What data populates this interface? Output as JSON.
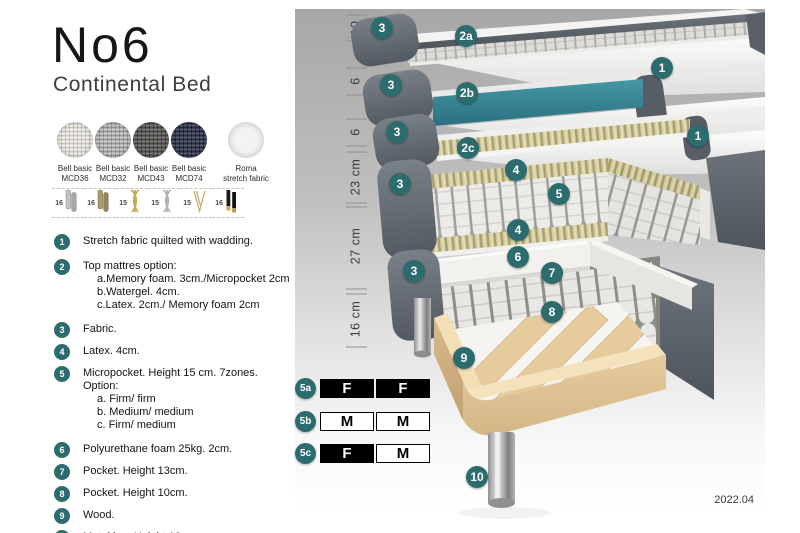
{
  "header": {
    "title": "No6",
    "subtitle": "Continental Bed"
  },
  "fabric_swatches": [
    {
      "line1": "Bell basic",
      "line2": "MCD36",
      "swatch": "weave-cream"
    },
    {
      "line1": "Bell basic",
      "line2": "MCD32",
      "swatch": "weave-grey"
    },
    {
      "line1": "Bell basic",
      "line2": "MCD43",
      "swatch": "weave-darkgrey"
    },
    {
      "line1": "Bell basic",
      "line2": "MCD74",
      "swatch": "weave-navy"
    },
    {
      "line1": "Roma",
      "line2": "stretch fabric",
      "swatch": "plain-white"
    }
  ],
  "leg_options": [
    {
      "height": "16",
      "icon": "cylinder-silver-leg"
    },
    {
      "height": "16",
      "icon": "cylinder-bronze-leg"
    },
    {
      "height": "15",
      "icon": "twisted-gold-leg"
    },
    {
      "height": "15",
      "icon": "twisted-silver-leg"
    },
    {
      "height": "15",
      "icon": "hairpin-leg"
    },
    {
      "height": "16",
      "icon": "black-gold-leg"
    }
  ],
  "features": [
    {
      "num": "1",
      "text": "Stretch fabric quilted with wadding.",
      "subitems": []
    },
    {
      "num": "2",
      "text": "Top mattres option:",
      "subitems": [
        "a.Memory foam. 3cm./Micropocket 2cm",
        "b.Watergel. 4cm.",
        "c.Latex. 2cm./ Memory foam 2cm"
      ]
    },
    {
      "num": "3",
      "text": "Fabric.",
      "subitems": []
    },
    {
      "num": "4",
      "text": "Latex. 4cm.",
      "subitems": []
    },
    {
      "num": "5",
      "text": "Micropocket. Height 15 cm. 7zones. Option:",
      "subitems": [
        "a. Firm/ firm",
        "b. Medium/ medium",
        "c. Firm/ medium"
      ]
    },
    {
      "num": "6",
      "text": "Polyurethane foam 25kg. 2cm.",
      "subitems": []
    },
    {
      "num": "7",
      "text": "Pocket. Height 13cm.",
      "subitems": []
    },
    {
      "num": "8",
      "text": "Pocket. Height 10cm.",
      "subitems": []
    },
    {
      "num": "9",
      "text": "Wood.",
      "subitems": []
    },
    {
      "num": "10",
      "text": "Metal leg. Height 16cm.",
      "subitems": []
    }
  ],
  "diagram": {
    "callouts": [
      {
        "label": "3",
        "x": 382,
        "y": 28
      },
      {
        "label": "2a",
        "x": 466,
        "y": 36
      },
      {
        "label": "1",
        "x": 662,
        "y": 68
      },
      {
        "label": "3",
        "x": 391,
        "y": 85
      },
      {
        "label": "2b",
        "x": 467,
        "y": 93
      },
      {
        "label": "3",
        "x": 397,
        "y": 132
      },
      {
        "label": "2c",
        "x": 468,
        "y": 148
      },
      {
        "label": "1",
        "x": 698,
        "y": 136
      },
      {
        "label": "3",
        "x": 400,
        "y": 184
      },
      {
        "label": "4",
        "x": 516,
        "y": 170
      },
      {
        "label": "5",
        "x": 559,
        "y": 194
      },
      {
        "label": "4",
        "x": 518,
        "y": 230
      },
      {
        "label": "6",
        "x": 518,
        "y": 257
      },
      {
        "label": "3",
        "x": 414,
        "y": 271
      },
      {
        "label": "7",
        "x": 552,
        "y": 273
      },
      {
        "label": "8",
        "x": 552,
        "y": 312
      },
      {
        "label": "9",
        "x": 464,
        "y": 358
      },
      {
        "label": "10",
        "x": 477,
        "y": 477
      }
    ],
    "ruler": [
      {
        "label": "10",
        "y": 28,
        "ticks": [
          15,
          41
        ]
      },
      {
        "label": "6",
        "y": 81,
        "ticks": [
          68,
          95
        ]
      },
      {
        "label": "6",
        "y": 132,
        "ticks": [
          119,
          146
        ]
      },
      {
        "label": "23 cm",
        "y": 177,
        "ticks": [
          152,
          203
        ]
      },
      {
        "label": "27 cm",
        "y": 246,
        "ticks": [
          207,
          289
        ]
      },
      {
        "label": "16 cm",
        "y": 319,
        "ticks": [
          294,
          347
        ]
      }
    ],
    "firmness_rows": [
      {
        "id": "5a",
        "cells": [
          {
            "letter": "F",
            "filled": true
          },
          {
            "letter": "F",
            "filled": true
          }
        ]
      },
      {
        "id": "5b",
        "cells": [
          {
            "letter": "M",
            "filled": false
          },
          {
            "letter": "M",
            "filled": false
          }
        ]
      },
      {
        "id": "5c",
        "cells": [
          {
            "letter": "F",
            "filled": true
          },
          {
            "letter": "M",
            "filled": false
          }
        ]
      }
    ],
    "version": "2022.04"
  },
  "colors": {
    "accent_teal": "#2d6c6e",
    "watergel_teal": "#35818f",
    "cover_grey": "#5f656d",
    "wood": "#e3c79a"
  }
}
